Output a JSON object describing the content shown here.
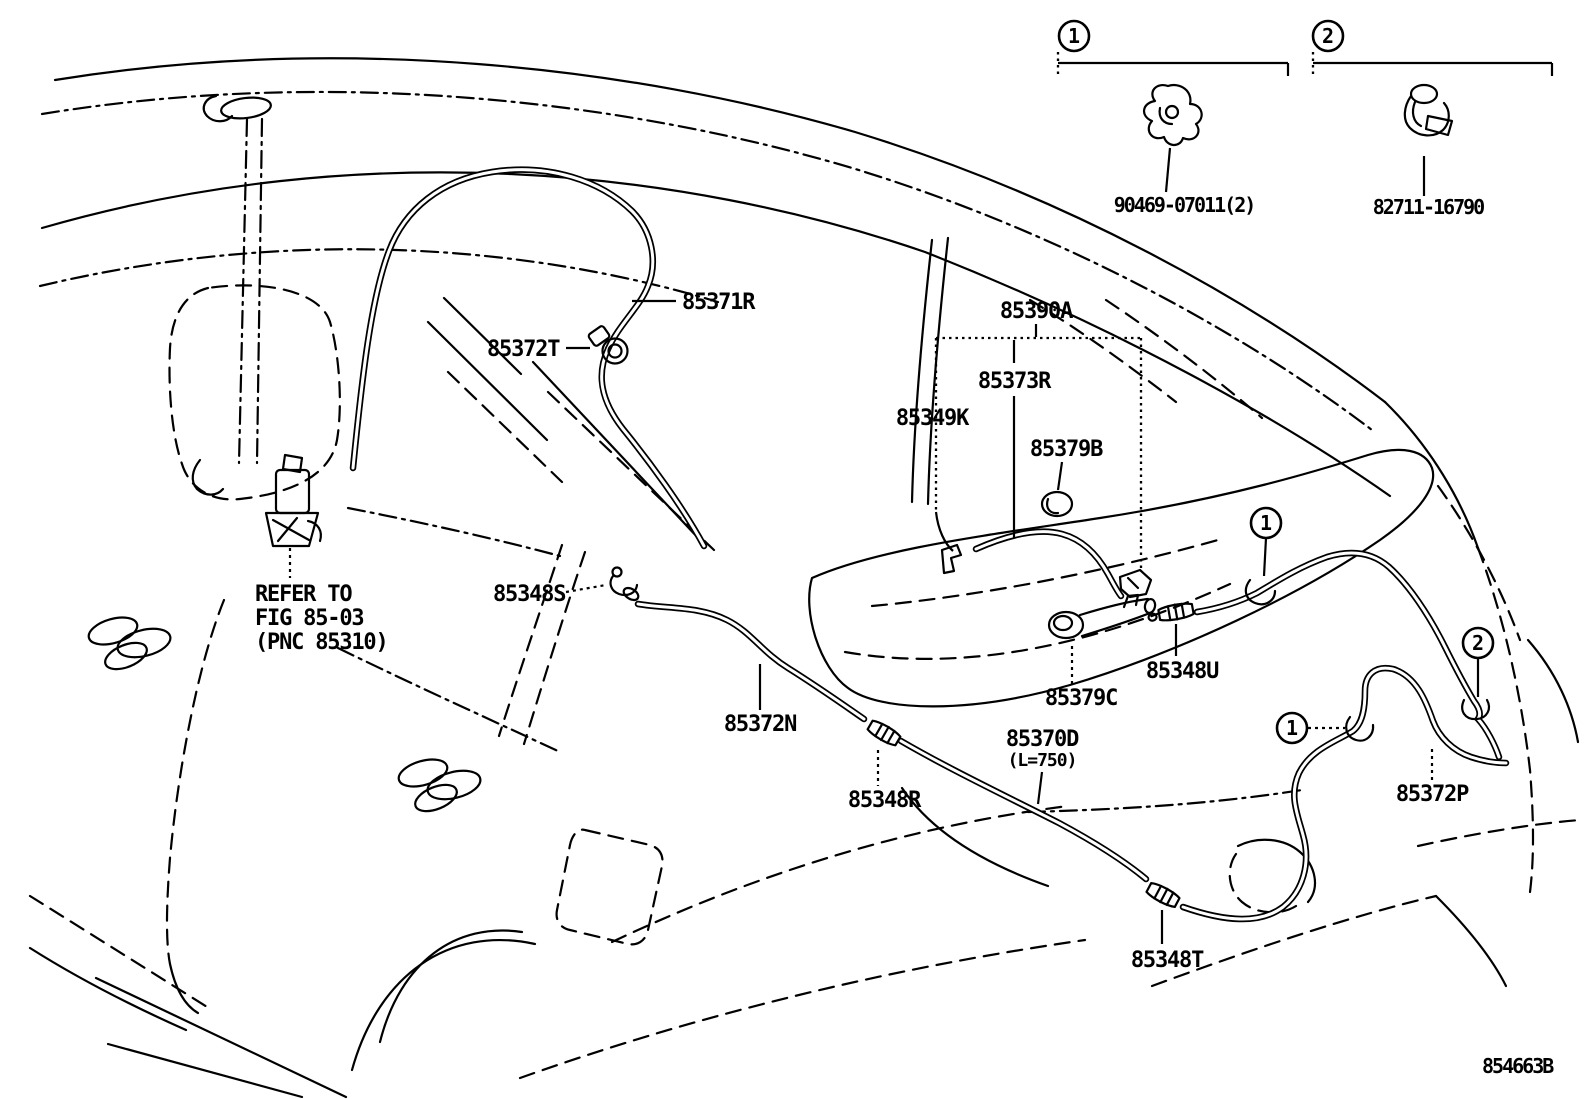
{
  "figure": {
    "drawing_number": "854663B",
    "colors": {
      "line": "#000000",
      "background": "#ffffff"
    },
    "reference_note": {
      "line1": "REFER TO",
      "line2": "FIG 85-03",
      "line3": "(PNC 85310)"
    },
    "legend": [
      {
        "number": "1",
        "part_number": "90469-07011(2)"
      },
      {
        "number": "2",
        "part_number": "82711-16790"
      }
    ],
    "parts": {
      "p85371R": "85371R",
      "p85372T": "85372T",
      "p85390A": "85390A",
      "p85373R": "85373R",
      "p85349K": "85349K",
      "p85379B": "85379B",
      "p85348S": "85348S",
      "p85372N": "85372N",
      "p85379C": "85379C",
      "p85348U": "85348U",
      "p85348R": "85348R",
      "p85370D": "85370D",
      "p85370D_len": "(L=750)",
      "p85348T": "85348T",
      "p85372P": "85372P"
    }
  }
}
